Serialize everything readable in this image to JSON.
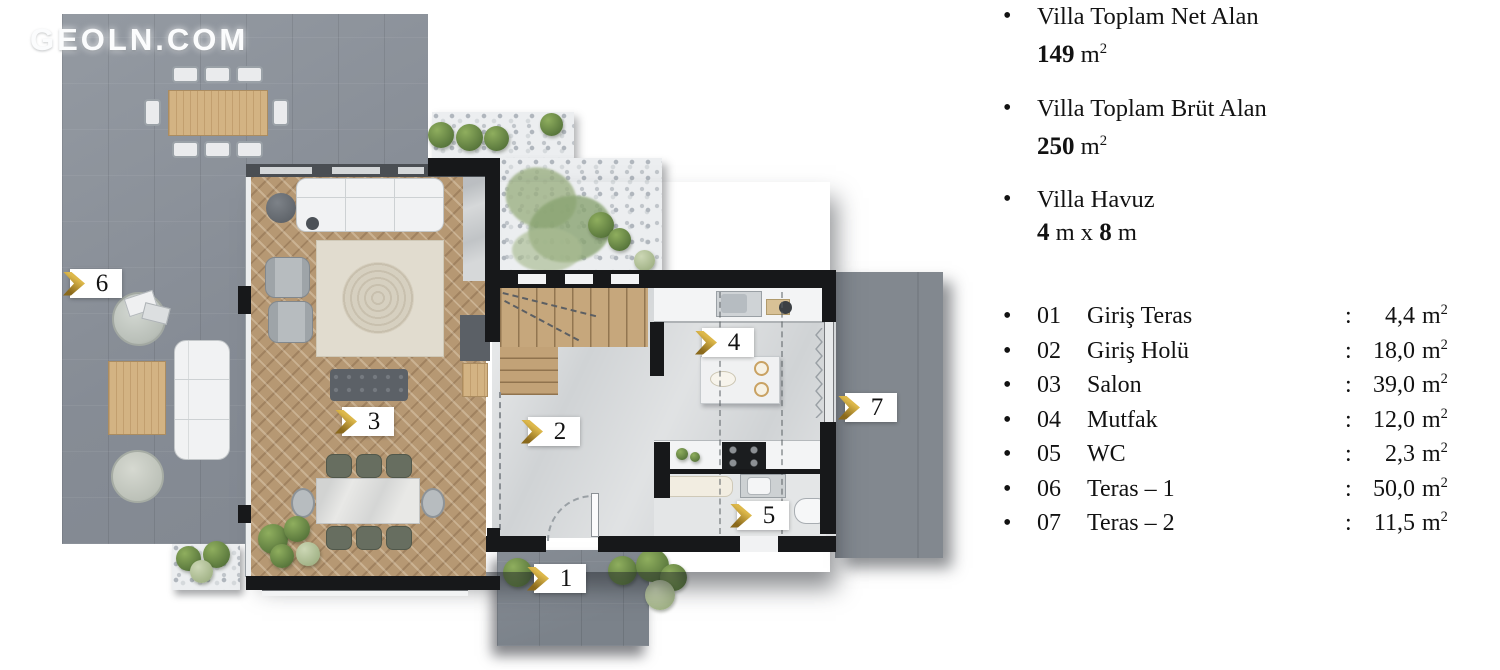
{
  "watermark": "GEOLN.COM",
  "summary": [
    {
      "label": "Villa Toplam Net Alan",
      "value": "149"
    },
    {
      "label": "Villa Toplam Brüt Alan",
      "value": "250"
    },
    {
      "label": "Villa Havuz",
      "value1": "4",
      "mid": " m x ",
      "value2": "8",
      "tail": " m"
    }
  ],
  "rooms": [
    {
      "num": "01",
      "name": "Giriş Teras",
      "area": "4,4"
    },
    {
      "num": "02",
      "name": "Giriş Holü",
      "area": "18,0"
    },
    {
      "num": "03",
      "name": "Salon",
      "area": "39,0"
    },
    {
      "num": "04",
      "name": "Mutfak",
      "area": "12,0"
    },
    {
      "num": "05",
      "name": "WC",
      "area": "2,3"
    },
    {
      "num": "06",
      "name": "Teras – 1",
      "area": "50,0"
    },
    {
      "num": "07",
      "name": "Teras – 2",
      "area": "11,5"
    }
  ],
  "units": {
    "bullet": "•",
    "colon": ":",
    "m": "m",
    "sup": "2"
  },
  "plan_labels": [
    "1",
    "2",
    "3",
    "4",
    "5",
    "6",
    "7"
  ],
  "colors": {
    "gold": "#c59f35",
    "gold_dark": "#8a691c",
    "wall": "#17181a",
    "terrace_gray": "#8e949c",
    "terrace_dark_gray": "#82888f",
    "wood_floor": "#b69873",
    "stairs_wood": "#c6a77c",
    "floor_light": "#d0d3d5",
    "gravel": "#eceef0",
    "plant_green": "#6f8f4d"
  }
}
